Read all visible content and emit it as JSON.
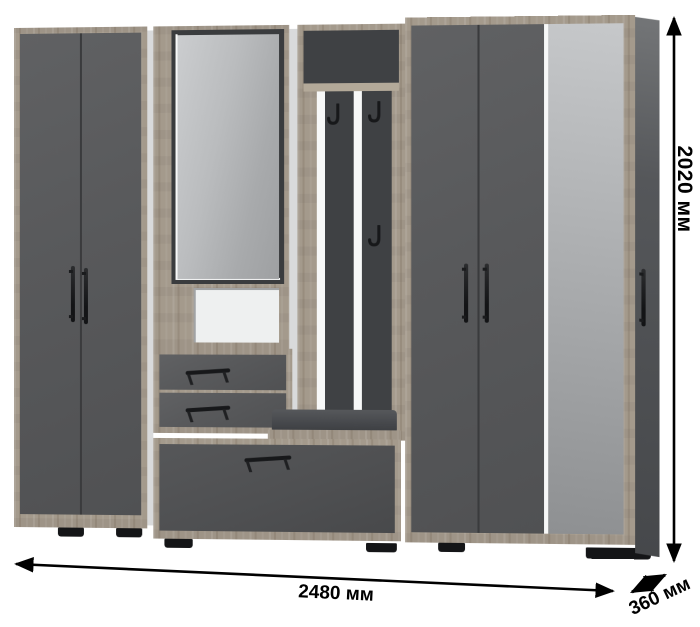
{
  "diagram": {
    "subject": "hallway-wardrobe-set",
    "background": "#ffffff"
  },
  "dimensions": {
    "height_label": "2020 мм",
    "width_label": "2480 мм",
    "depth_label": "360 мм"
  },
  "palette": {
    "front_gray": "#58595b",
    "panel_dark_gray": "#3f4144",
    "wood_oak": "#a49a8c",
    "mirror_gray": "#b5b7b9",
    "niche_white": "#eef0f0",
    "hardware_black": "#151618",
    "annotation_black": "#000000"
  },
  "parts": {
    "left_wardrobe": "two-door wardrobe",
    "mirror_cabinet": "mirror with lit niche and two drawers",
    "coat_rack": "slatted panel with three hooks and bench seat",
    "shoe_drawer": "wide bottom drawer",
    "right_wardrobe": "two-door wardrobe with tall mirror door"
  }
}
